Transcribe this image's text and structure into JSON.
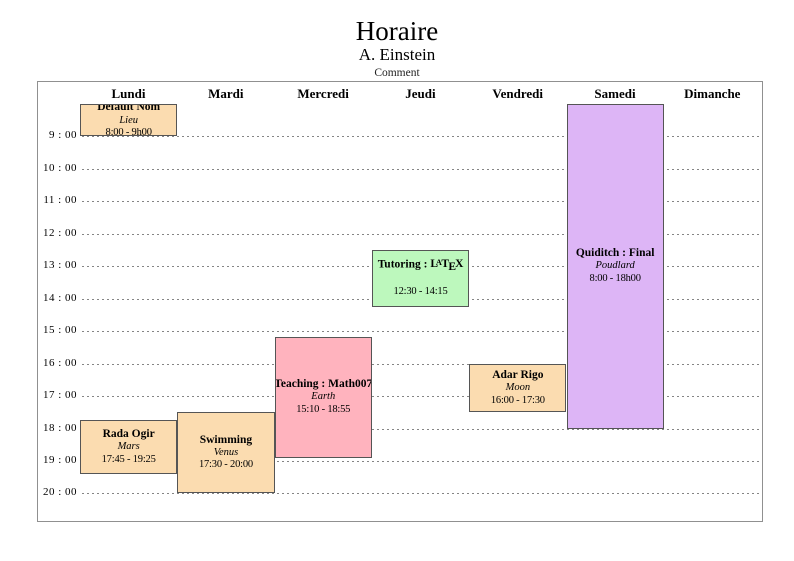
{
  "page": {
    "title": "Horaire",
    "subtitle": "A. Einstein",
    "comment": "Comment"
  },
  "calendar": {
    "days": [
      "Lundi",
      "Mardi",
      "Mercredi",
      "Jeudi",
      "Vendredi",
      "Samedi",
      "Dimanche"
    ],
    "hour_labels": [
      "9 : 00",
      "10 : 00",
      "11 : 00",
      "12 : 00",
      "13 : 00",
      "14 : 00",
      "15 : 00",
      "16 : 00",
      "17 : 00",
      "18 : 00",
      "19 : 00",
      "20 : 00"
    ],
    "hour_start": 9,
    "hour_end": 20,
    "events": [
      {
        "id": "default-nom",
        "title": "Default Nom",
        "location": "Lieu",
        "time": "8:00 - 9h00",
        "day": 0,
        "start": 8.0,
        "end": 9.0,
        "color": "#fbdcb0"
      },
      {
        "id": "rada-ogir",
        "title": "Rada Ogir",
        "location": "Mars",
        "time": "17:45 - 19:25",
        "day": 0,
        "start": 17.75,
        "end": 19.4167,
        "color": "#fbdcb0"
      },
      {
        "id": "swimming",
        "title": "Swimming",
        "location": "Venus",
        "time": "17:30 - 20:00",
        "day": 1,
        "start": 17.5,
        "end": 20.0,
        "color": "#fbdcb0"
      },
      {
        "id": "teaching-math007",
        "title": "Teaching : Math007",
        "location": "Earth",
        "time": "15:10 - 18:55",
        "day": 2,
        "start": 15.1667,
        "end": 18.9167,
        "color": "#ffb3be"
      },
      {
        "id": "tutoring-latex",
        "title": "Tutoring : LaTeX",
        "title_prefix": "Tutoring : ",
        "logo": "LaTeX",
        "location": "",
        "time": "12:30 - 14:15",
        "day": 3,
        "start": 12.5,
        "end": 14.25,
        "color": "#bdf8bd"
      },
      {
        "id": "adar-rigo",
        "title": "Adar Rigo",
        "location": "Moon",
        "time": "16:00 - 17:30",
        "day": 4,
        "start": 16.0,
        "end": 17.5,
        "color": "#fbdcb0"
      },
      {
        "id": "quiditch-final",
        "title": "Quiditch : Final",
        "location": "Poudlard",
        "time": "8:00 - 18h00",
        "day": 5,
        "start": 8.0,
        "end": 18.0,
        "color": "#ddb5f6"
      }
    ]
  },
  "colors": {
    "event_border": "#555555",
    "frame_border": "#909090",
    "gridline": "#858585",
    "peach": "#fbdcb0",
    "pink": "#ffb3be",
    "green": "#bdf8bd",
    "purple": "#ddb5f6"
  }
}
